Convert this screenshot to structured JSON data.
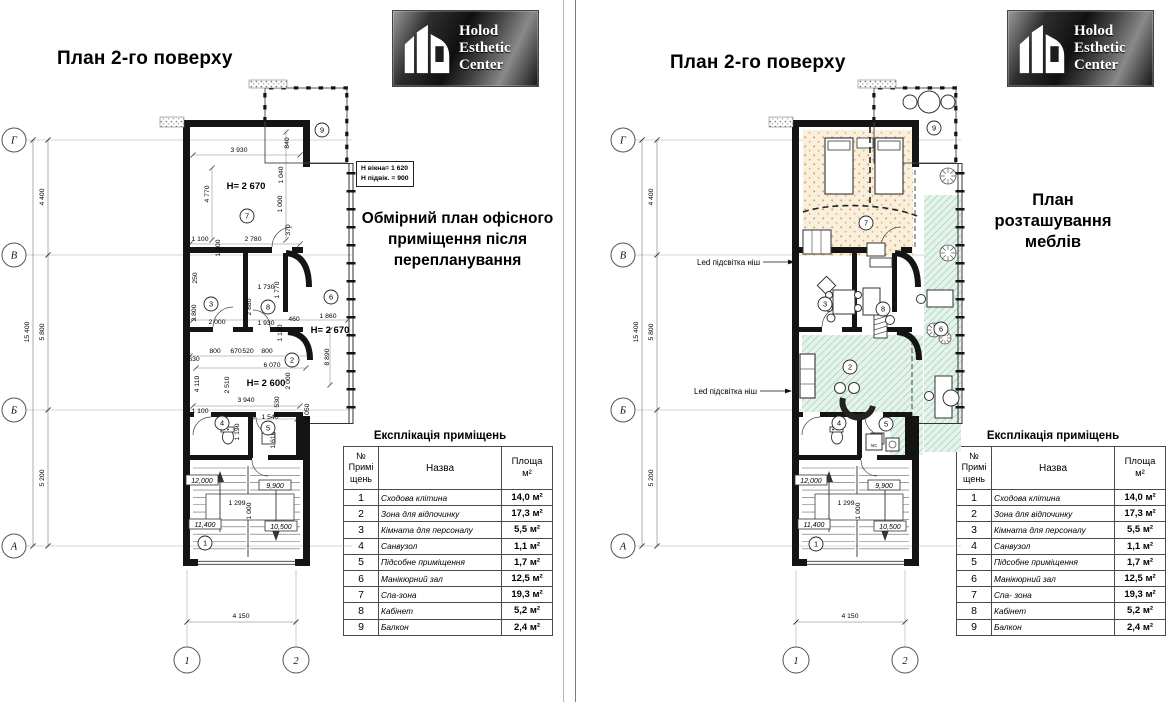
{
  "logo": {
    "lines": [
      "Holod",
      "Esthetic",
      "Center"
    ]
  },
  "left_page": {
    "title": "План 2-го поверху",
    "note_lines": [
      "H вікна= 1 620",
      "H підвік. = 900"
    ],
    "annotation_lines": [
      "Обмірний план офісного",
      "приміщення після",
      "перепланування"
    ]
  },
  "right_page": {
    "title": "План 2-го поверху",
    "annotation_lines": [
      "План",
      "розташування",
      "меблів"
    ],
    "led_labels": [
      "Led підсвітка ніш",
      "Led підсвітка ніш"
    ],
    "mc_label": "мс"
  },
  "axes": {
    "rows": [
      "Г",
      "В",
      "Б",
      "А"
    ],
    "row_dims": [
      "4 400",
      "5 800",
      "5 200"
    ],
    "total_dim": "15 400",
    "cols": [
      "1",
      "2"
    ],
    "col_dim": "4 150"
  },
  "expl": {
    "title": "Експлікація приміщень",
    "headers": {
      "num": [
        "№",
        "Примі",
        "щень"
      ],
      "name": "Назва",
      "area": [
        "Площа",
        "м²"
      ]
    },
    "left_rows": [
      {
        "n": "1",
        "name": "Сходова клітина",
        "area": "14,0 м²"
      },
      {
        "n": "2",
        "name": "Зона для відпочинку",
        "area": "17,3 м²"
      },
      {
        "n": "3",
        "name": "Кімната для персоналу",
        "area": "5,5 м²"
      },
      {
        "n": "4",
        "name": "Санвузол",
        "area": "1,1 м²"
      },
      {
        "n": "5",
        "name": "Підсобне приміщення",
        "area": "1,7 м²"
      },
      {
        "n": "6",
        "name": "Манікюрний зал",
        "area": "12,5 м²"
      },
      {
        "n": "7",
        "name": "Спа-зона",
        "area": "19,3 м²"
      },
      {
        "n": "8",
        "name": "Кабінет",
        "area": "5,2 м²"
      },
      {
        "n": "9",
        "name": "Балкон",
        "area": "2,4 м²"
      }
    ],
    "right_rows": [
      {
        "n": "1",
        "name": "Сходова клітина",
        "area": "14,0 м²"
      },
      {
        "n": "2",
        "name": "Зона для відпочинку",
        "area": "17,3 м²"
      },
      {
        "n": "3",
        "name": "Кімната для персоналу",
        "area": "5,5 м²"
      },
      {
        "n": "4",
        "name": "Санвузол",
        "area": "1,1 м²"
      },
      {
        "n": "5",
        "name": "Підсобне приміщення",
        "area": "1,7 м²"
      },
      {
        "n": "6",
        "name": "Манікюрний зал",
        "area": "12,5 м²"
      },
      {
        "n": "7",
        "name": "Спа- зона",
        "area": "19,3 м²"
      },
      {
        "n": "8",
        "name": "Кабінет",
        "area": "5,2 м²"
      },
      {
        "n": "9",
        "name": "Балкон",
        "area": "2,4 м²"
      }
    ]
  },
  "plan": {
    "h_labels": [
      {
        "t": "H= 2 670",
        "x": 246,
        "y": 189
      },
      {
        "t": "H= 2 670",
        "x": 330,
        "y": 333
      },
      {
        "t": "H= 2 600",
        "x": 266,
        "y": 386
      }
    ],
    "dim_labels": [
      {
        "t": "3 930",
        "x": 239,
        "y": 152
      },
      {
        "t": "840",
        "x": 289,
        "y": 143,
        "r": -90
      },
      {
        "t": "4 770",
        "x": 209,
        "y": 194,
        "r": -90
      },
      {
        "t": "1 040",
        "x": 283,
        "y": 175,
        "r": -90
      },
      {
        "t": "1 000",
        "x": 282,
        "y": 204,
        "r": -90
      },
      {
        "t": "370",
        "x": 290,
        "y": 230,
        "r": -90
      },
      {
        "t": "1 100",
        "x": 200,
        "y": 241
      },
      {
        "t": "1 100",
        "x": 220,
        "y": 248,
        "r": -90
      },
      {
        "t": "2 780",
        "x": 253,
        "y": 241
      },
      {
        "t": "250",
        "x": 197,
        "y": 278,
        "r": -90
      },
      {
        "t": "2 800",
        "x": 196,
        "y": 313,
        "r": -90
      },
      {
        "t": "2 000",
        "x": 217,
        "y": 324
      },
      {
        "t": "1 730",
        "x": 266,
        "y": 289
      },
      {
        "t": "1 770",
        "x": 279,
        "y": 290,
        "r": -90
      },
      {
        "t": "2 880",
        "x": 251,
        "y": 307,
        "r": -90
      },
      {
        "t": "1 930",
        "x": 266,
        "y": 325
      },
      {
        "t": "460",
        "x": 294,
        "y": 321
      },
      {
        "t": "1 150",
        "x": 282,
        "y": 333,
        "r": -90
      },
      {
        "t": "1 860",
        "x": 328,
        "y": 318
      },
      {
        "t": "8 890",
        "x": 329,
        "y": 357,
        "r": -90
      },
      {
        "t": "800",
        "x": 215,
        "y": 353
      },
      {
        "t": "670",
        "x": 236,
        "y": 353
      },
      {
        "t": "520",
        "x": 248,
        "y": 353
      },
      {
        "t": "800",
        "x": 267,
        "y": 353
      },
      {
        "t": "630",
        "x": 194,
        "y": 361
      },
      {
        "t": "6 070",
        "x": 272,
        "y": 367
      },
      {
        "t": "4 110",
        "x": 199,
        "y": 384,
        "r": -90
      },
      {
        "t": "2 510",
        "x": 229,
        "y": 385,
        "r": -90
      },
      {
        "t": "2 000",
        "x": 290,
        "y": 381,
        "r": -90
      },
      {
        "t": "3 940",
        "x": 246,
        "y": 402
      },
      {
        "t": "530",
        "x": 279,
        "y": 402,
        "r": -90
      },
      {
        "t": "1 050",
        "x": 309,
        "y": 412,
        "r": -90
      },
      {
        "t": "1 100",
        "x": 200,
        "y": 413
      },
      {
        "t": "1 190",
        "x": 239,
        "y": 432,
        "r": -90
      },
      {
        "t": "1 540",
        "x": 270,
        "y": 419
      },
      {
        "t": "1 610",
        "x": 275,
        "y": 440,
        "r": -90
      }
    ],
    "elev_labels": [
      {
        "t": "12,000",
        "x": 202,
        "y": 481
      },
      {
        "t": "9,900",
        "x": 275,
        "y": 486
      },
      {
        "t": "11,400",
        "x": 205,
        "y": 525
      },
      {
        "t": "10,500",
        "x": 281,
        "y": 527
      }
    ],
    "stair_dims": [
      {
        "t": "1 299",
        "x": 237,
        "y": 505
      },
      {
        "t": "1 000",
        "x": 251,
        "y": 511,
        "r": -90
      }
    ],
    "rooms_left": [
      {
        "n": "1",
        "x": 205,
        "y": 543
      },
      {
        "n": "2",
        "x": 292,
        "y": 360
      },
      {
        "n": "3",
        "x": 211,
        "y": 304
      },
      {
        "n": "4",
        "x": 222,
        "y": 423
      },
      {
        "n": "5",
        "x": 268,
        "y": 428
      },
      {
        "n": "6",
        "x": 331,
        "y": 297
      },
      {
        "n": "7",
        "x": 247,
        "y": 216
      },
      {
        "n": "8",
        "x": 268,
        "y": 307
      },
      {
        "n": "9",
        "x": 322,
        "y": 130
      }
    ],
    "rooms_right": [
      {
        "n": "1",
        "x": 229,
        "y": 544
      },
      {
        "n": "2",
        "x": 263,
        "y": 367
      },
      {
        "n": "3",
        "x": 238,
        "y": 304
      },
      {
        "n": "4",
        "x": 252,
        "y": 423
      },
      {
        "n": "5",
        "x": 299,
        "y": 424
      },
      {
        "n": "6",
        "x": 354,
        "y": 329
      },
      {
        "n": "7",
        "x": 279,
        "y": 223
      },
      {
        "n": "8",
        "x": 296,
        "y": 309
      },
      {
        "n": "9",
        "x": 347,
        "y": 128
      }
    ]
  }
}
